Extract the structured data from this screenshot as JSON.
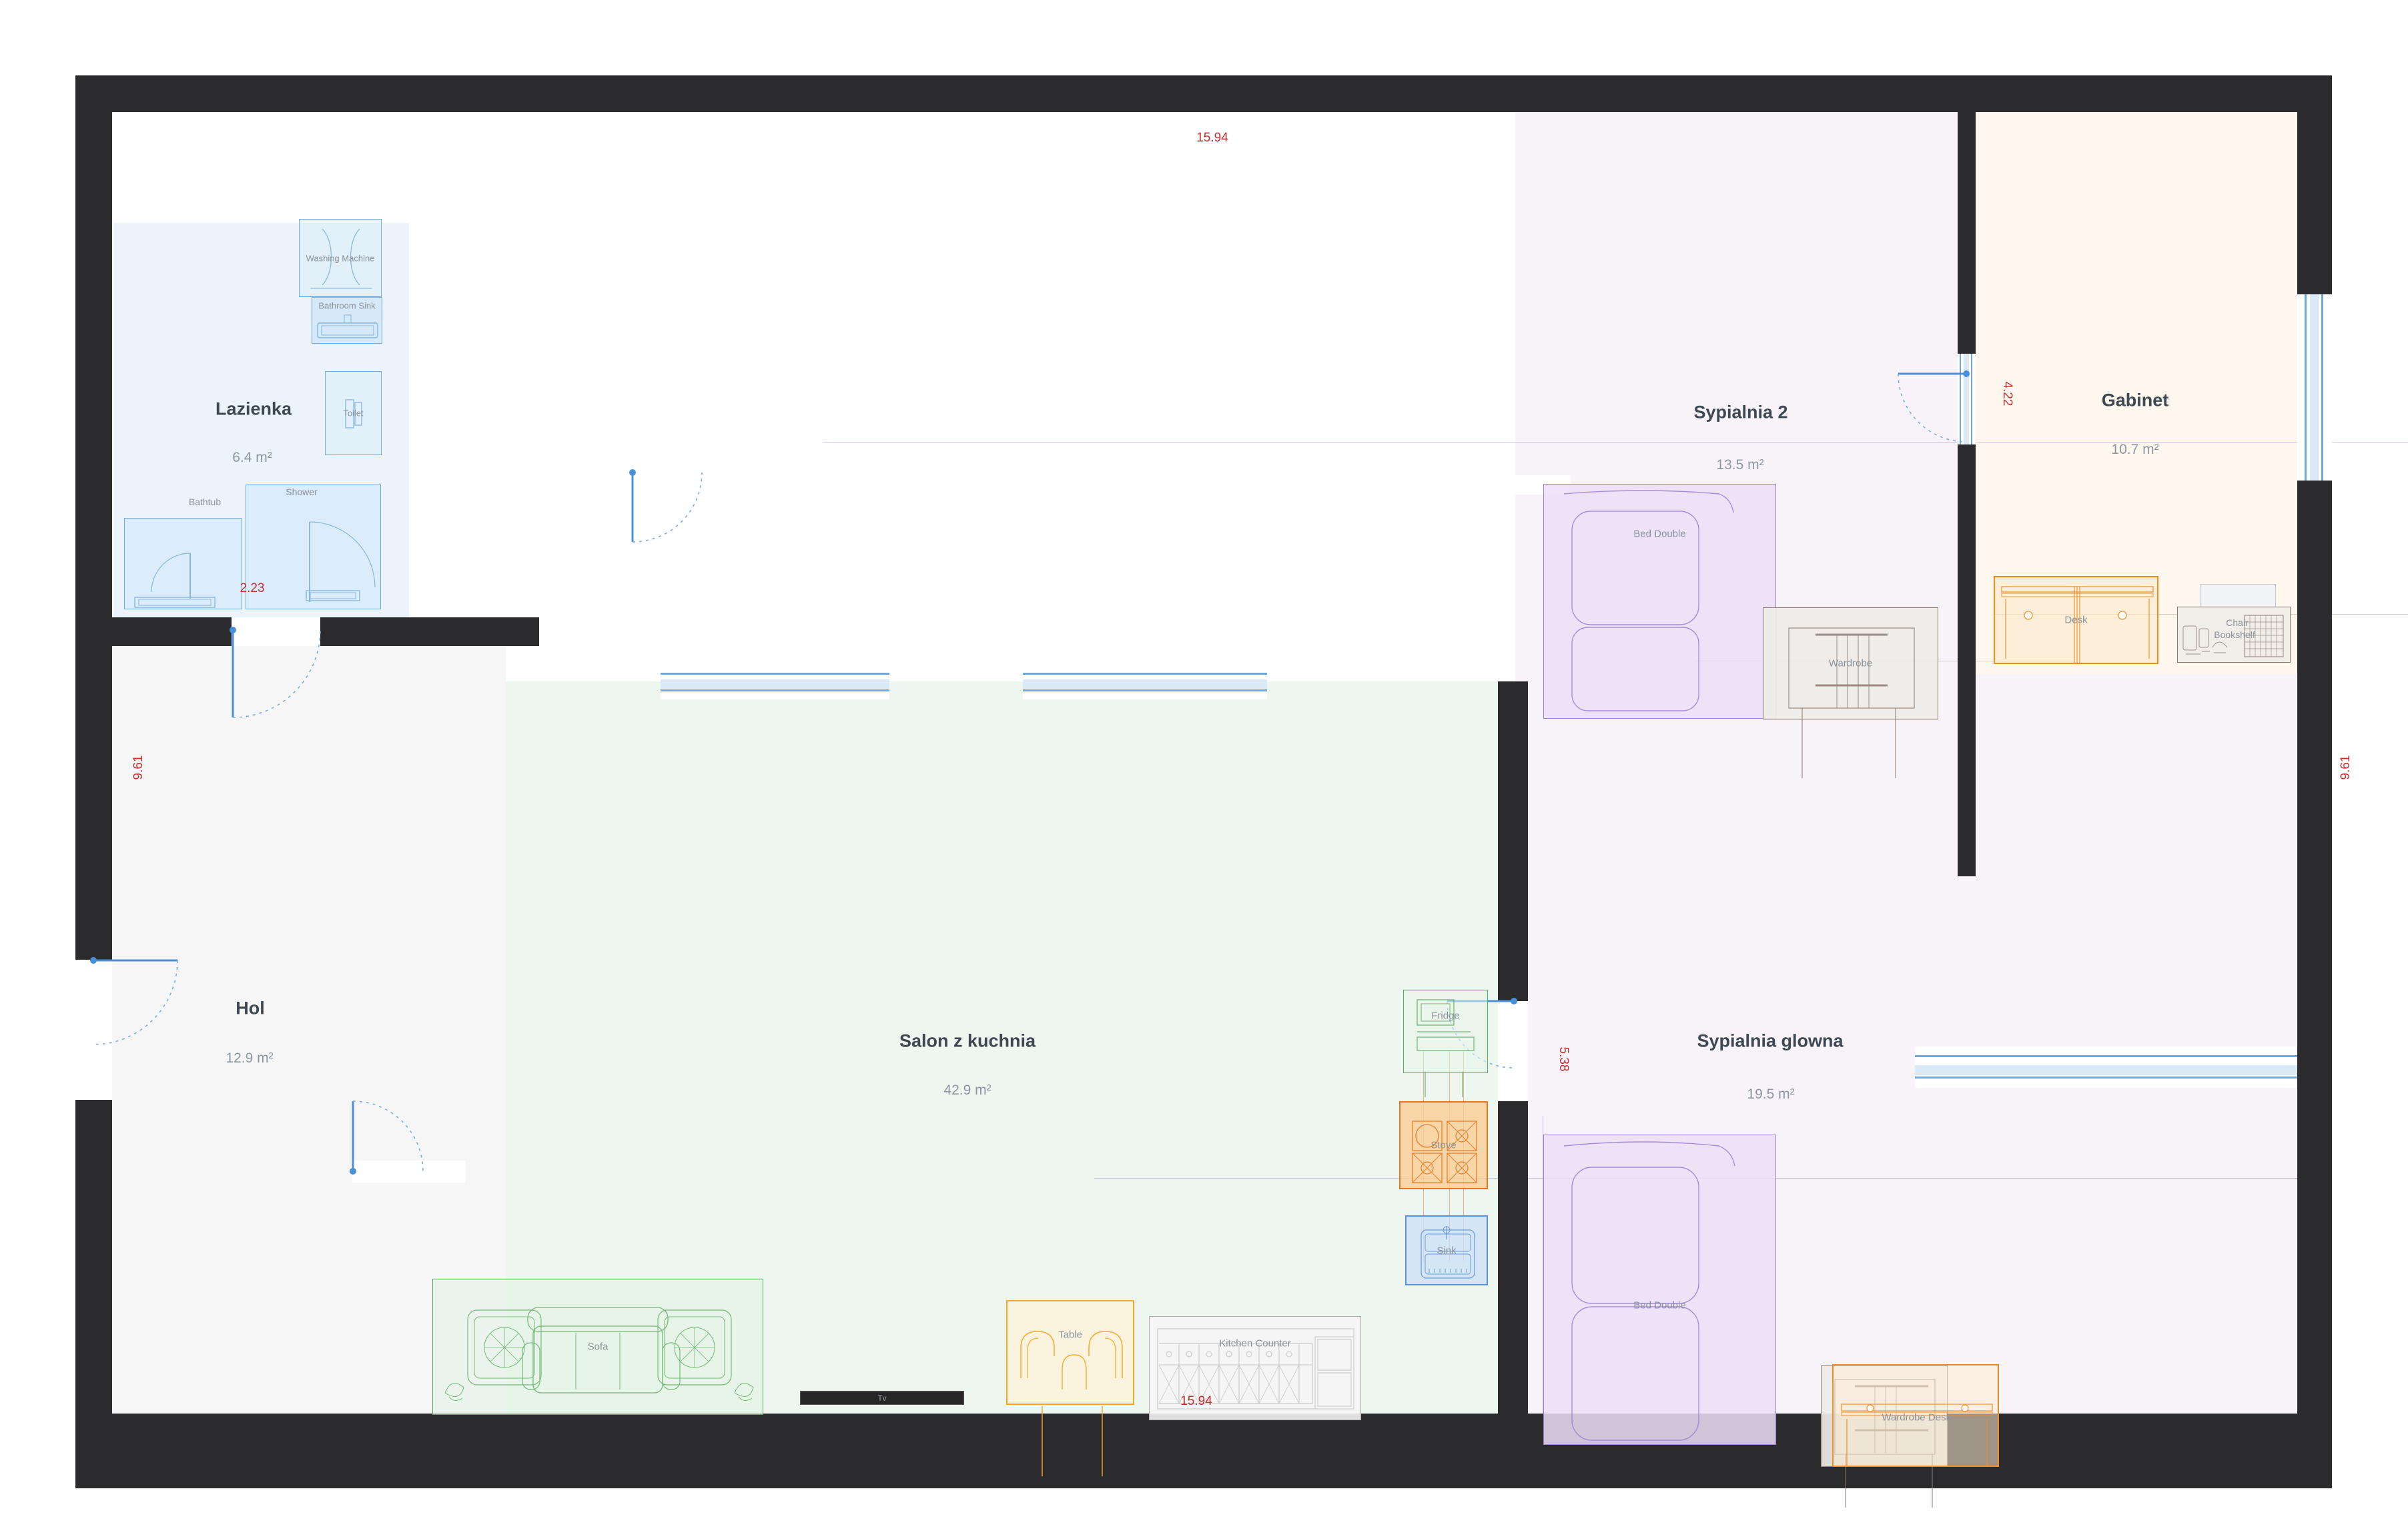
{
  "rooms": {
    "lazienka": {
      "name": "Lazienka",
      "area": "6.4 m²"
    },
    "hol": {
      "name": "Hol",
      "area": "12.9 m²"
    },
    "salon": {
      "name": "Salon z kuchnia",
      "area": "42.9 m²"
    },
    "sypialnia2": {
      "name": "Sypialnia 2",
      "area": "13.5 m²"
    },
    "gabinet": {
      "name": "Gabinet",
      "area": "10.7 m²"
    },
    "sypialnia_glowna": {
      "name": "Sypialnia glowna",
      "area": "19.5 m²"
    }
  },
  "furniture": {
    "washing_machine": "Washing Machine",
    "bathroom_sink": "Bathroom Sink",
    "toilet": "Toilet",
    "shower": "Shower",
    "bathtub": "Bathtub",
    "sofa": "Sofa",
    "tv": "Tv",
    "table": "Table",
    "kitchen_counter": "Kitchen Counter",
    "fridge": "Fridge",
    "stove": "Stove",
    "sink": "Sink",
    "bed_double_2": "Bed Double",
    "wardrobe_2": "Wardrobe",
    "bed_double_main": "Bed Double",
    "wardrobe_main": "Wardrobe",
    "desk_main": "Desk",
    "desk_gabinet": "Desk",
    "chair": "Chair",
    "bookshelf": "Bookshelf"
  },
  "dimensions": {
    "top_width": "15.94",
    "bottom_width": "15.94",
    "left_height": "9.61",
    "right_height": "9.61",
    "bathroom_width": "2.23",
    "gabinet_width": "4.22",
    "kitchen_height": "5.38"
  },
  "colors": {
    "wall": "#2b2b2e",
    "door": "#4a90d9",
    "window_frame": "#6fa8dc",
    "window_glass": "#dce9f6",
    "dimension_text": "#c62f2f",
    "bathroom_accent": "#74a9d8",
    "living_accent": "#58a85e",
    "bedroom_accent": "#9b7fd4",
    "office_accent": "#f08c1e",
    "table_accent": "#f5a623",
    "wardrobe_accent": "#8d7b70",
    "counter_accent": "#adadad"
  }
}
